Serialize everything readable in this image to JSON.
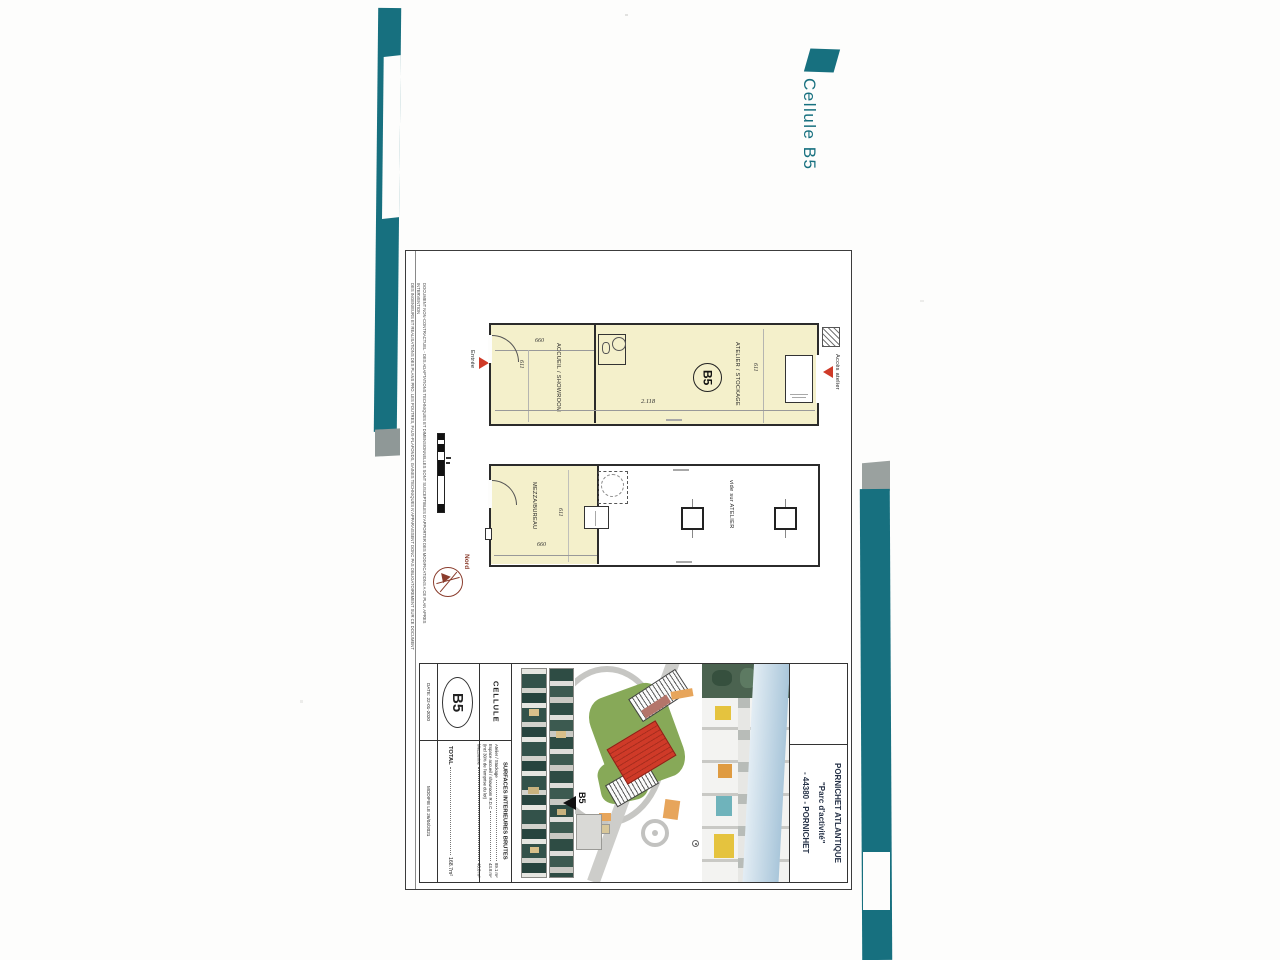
{
  "accent": {
    "teal": "#17707f",
    "red": "#cf3a28",
    "plan_fill": "#f4f0cb",
    "north_red": "#8a3c2c"
  },
  "header": {
    "title": "Cellule B5"
  },
  "disclaimer": {
    "line1": "DOCUMENT NON-CONTRACTUEL - DES ADAPTATIONS TECHNIQUES ET DIMENSIONNELLES SONT SUSCEPTIBLES D'APPORTER DES MODIFICATIONS A CE PLAN APRES INTERVENTION",
    "line2": "DES INGENIEURS ET REALISATIONS DES PLANS PRO. LES POUTRES, FAUX-PLAFONDS, GAINES TECHNIQUES N'APPARAISSENT DONC PAS OBLIGATOIREMENT SUR CE DOCUMENT"
  },
  "ground_floor": {
    "room_accueil": "ACCUEIL / SHOWROOM",
    "room_atelier": "ATELIER / STOCKAGE",
    "unit": "B5",
    "dim_660": "660",
    "dim_611_left": "611",
    "dim_611_right": "611",
    "dim_length": "2.118",
    "entry": "Entrée",
    "access": "Accès atelier"
  },
  "mezzanine": {
    "room": "MEZZA/BUREAU",
    "void": "vide sur ATELIER",
    "dim_611": "611",
    "dim_660": "660"
  },
  "north": {
    "label": "Nord"
  },
  "titleblock": {
    "date": "DATE: 22-01-2020",
    "modified": "MODIFIE LE 26/04/2021",
    "unit": "B5",
    "cellule": "CELLULE",
    "surfaces_title": "SURFACES INTERIEURES BRUTES",
    "rows": [
      {
        "label": "Atelier / Stockage",
        "value": "89.1 m²"
      },
      {
        "label": "Espace accueil / showroom R.D.C",
        "value": "43.8 m²"
      },
      {
        "label": "(incl 30% de l'emprise du lot)",
        "value": ""
      },
      {
        "label": "Mezzanine",
        "value": "40.8 m²"
      }
    ],
    "total_label": "TOTAL",
    "total_value": "168.7m²",
    "siteplan_unit": "B5",
    "project_line1": "PORNICHET ATLANTIQUE",
    "project_line2": "\"Parc d'activité\"",
    "project_line3": "- 44380 - PORNICHET"
  }
}
